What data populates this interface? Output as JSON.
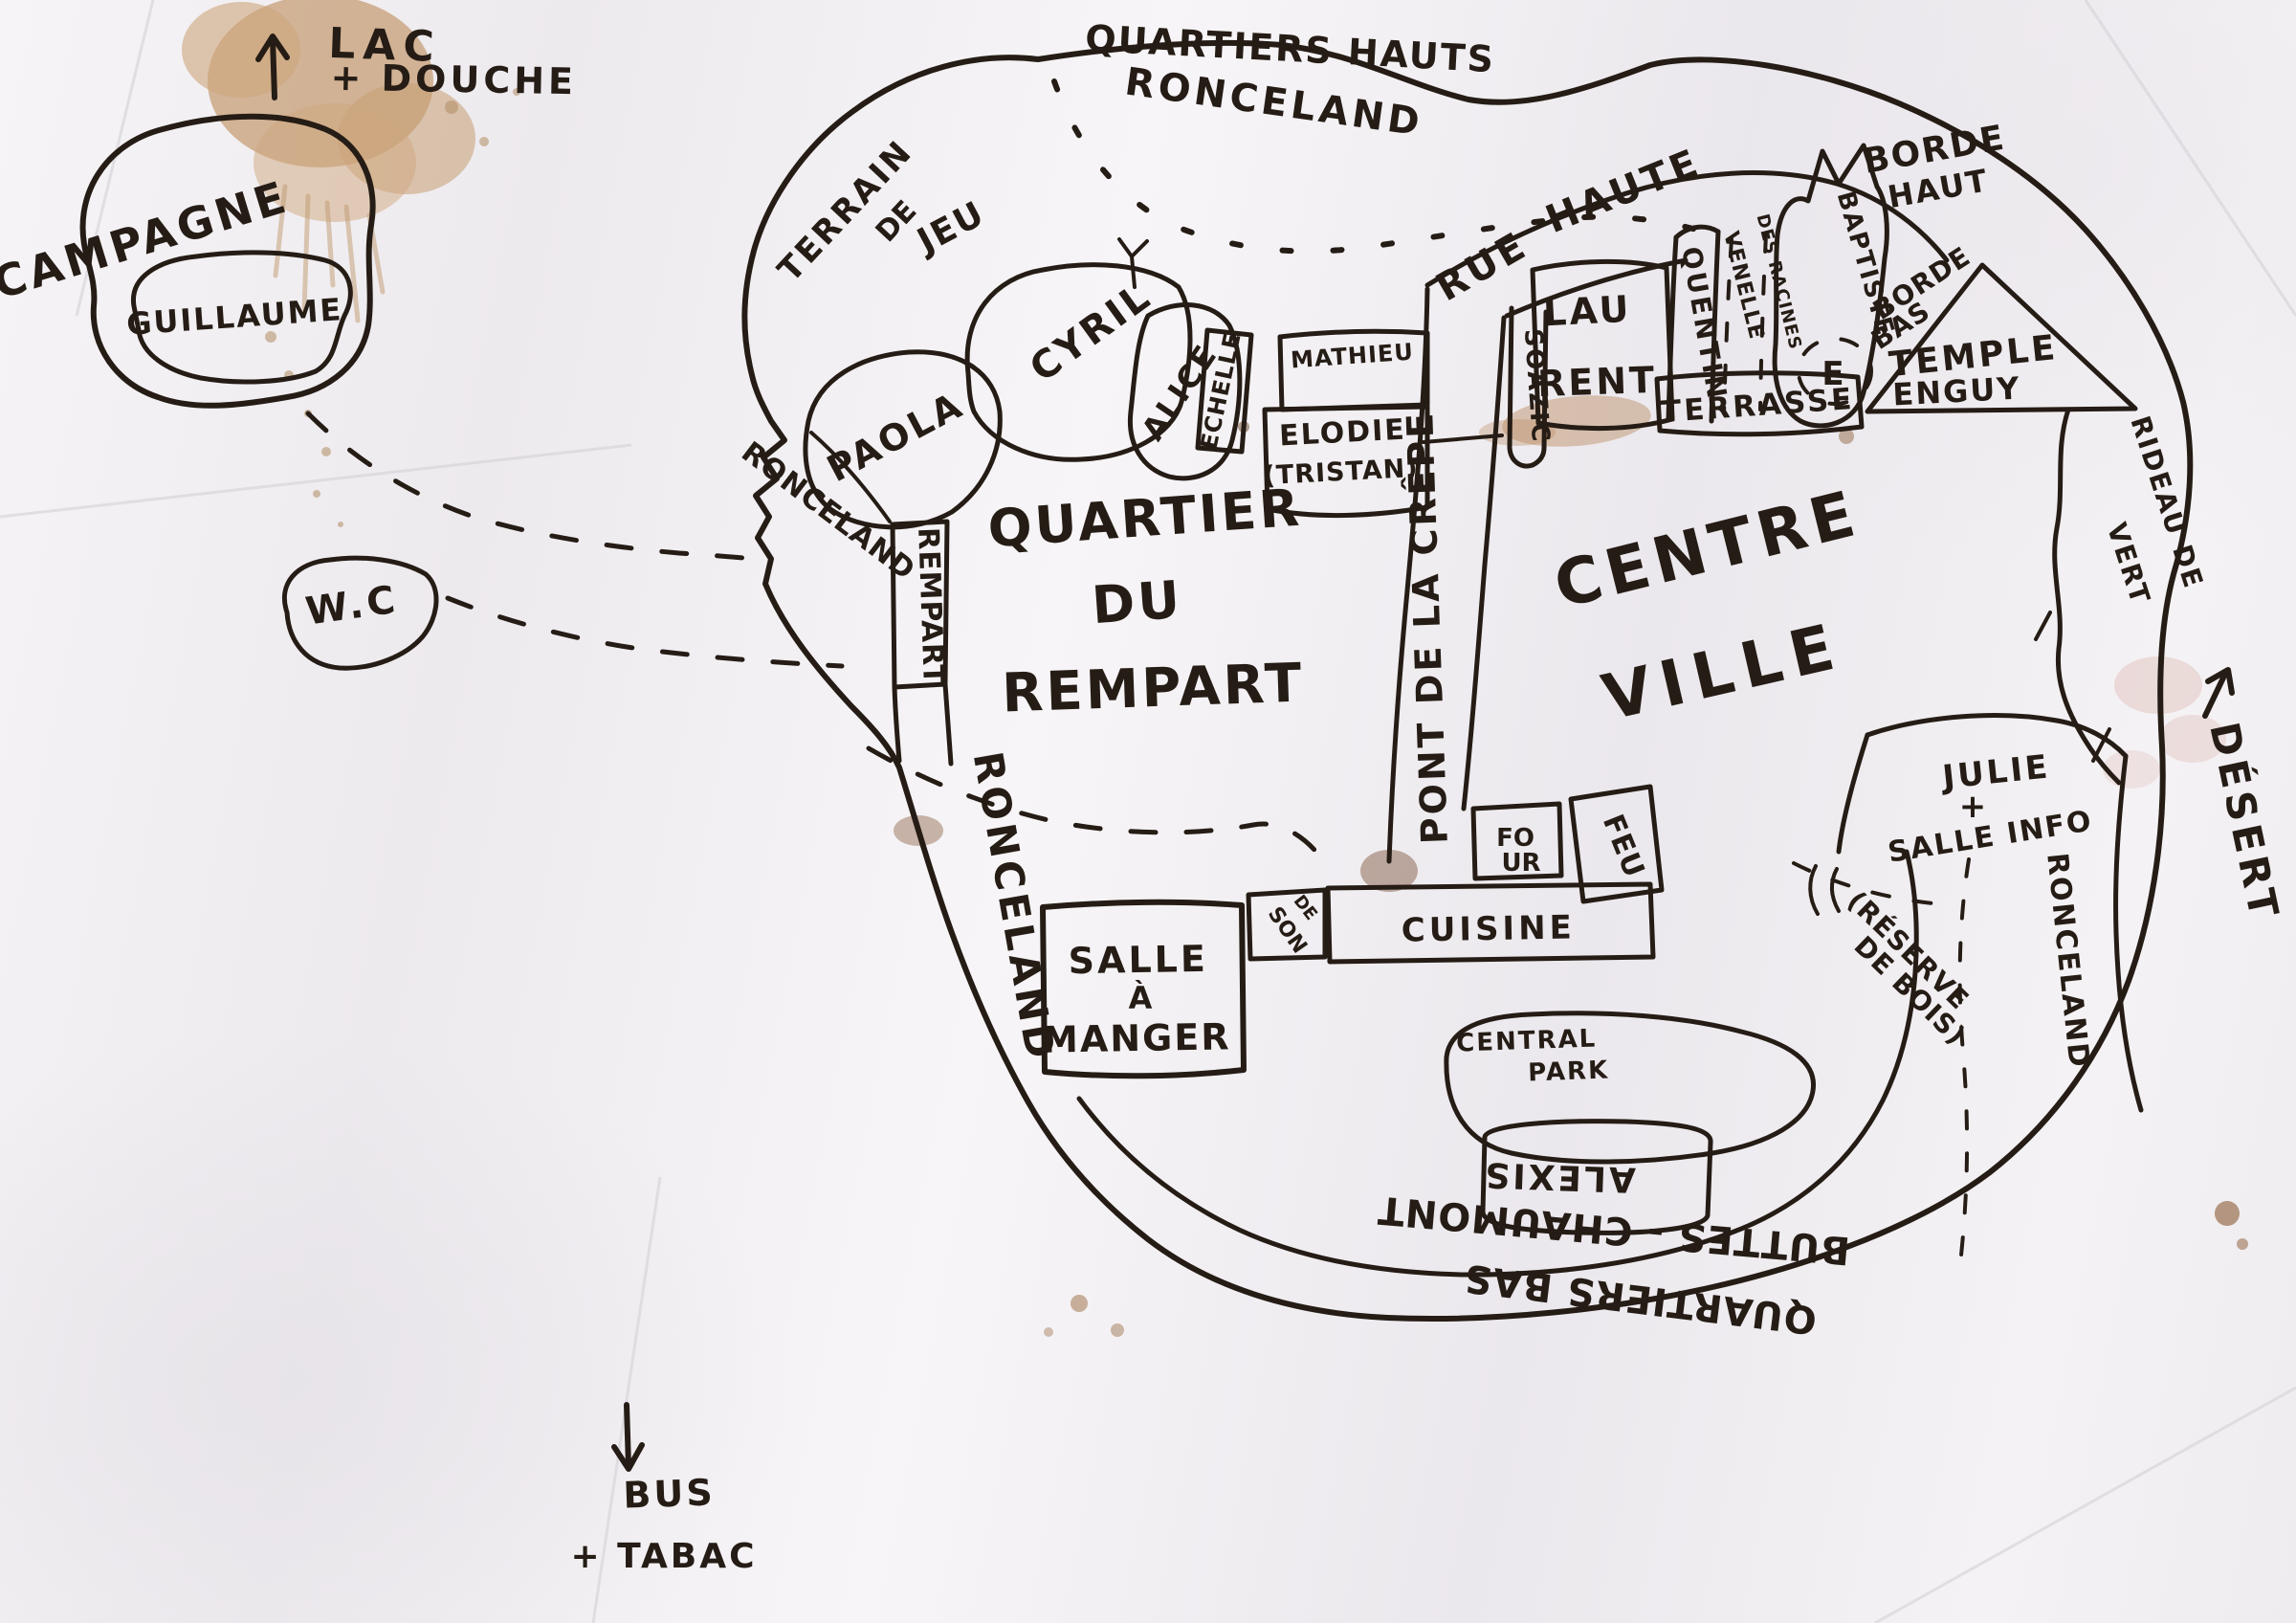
{
  "colors": {
    "ink": "#251c15",
    "paper": "#f2f0f3",
    "stain": "#c59b71"
  },
  "icons": {
    "arrow_up": "↑",
    "arrow_down": "↓"
  },
  "labels": {
    "lac": "LAC",
    "douche": "+ DOUCHE",
    "campagne": "CAMPAGNE",
    "guillaume": "GUILLAUME",
    "wc": "W.C",
    "bus": "BUS",
    "tabac": "+ TABAC",
    "desert": "DÉSERT",
    "quartiers_hauts": "QUARTIERS HAUTS",
    "ronceland_top": "RONCELAND",
    "terrain": "TERRAIN",
    "terrain_de": "DE",
    "jeu": "JEU",
    "paola": "PAOLA",
    "cyril": "CYRIL",
    "alice": "ALICE",
    "echelle": "ECHELLE",
    "mathieu": "MATHIEU",
    "elodie": "ELODIE",
    "tristan": "(TRISTAN)",
    "soazic": "SOAZIC",
    "lau": "LAU",
    "rent": "RENT",
    "quentin": "QUENTIN",
    "venelle": "VENELLE",
    "des_racines": "DES RACINES",
    "baptiste": "BAPTISTE",
    "e_spot": "E",
    "borde_haut_1": "BORDE",
    "borde_haut_2": "HAUT",
    "borde_bas_1": "BORDE",
    "borde_bas_2": "BAS",
    "temple": "TEMPLE",
    "enguy": "ENGUY",
    "terrasse": "TERRASSE",
    "rue": "RUE",
    "haute": "HAUTE",
    "rideau_de": "RIDEAU DE",
    "vert": "VERT",
    "quartier": "QUARTIER",
    "du": "DU",
    "rempart": "REMPART",
    "centre": "CENTRE",
    "ville": "VILLE",
    "pont_de_la_crepe": "PONT DE LA CRÊPE",
    "rempart_road": "REMPART",
    "ronceland_west": "RONCELAND",
    "ronceland_sw": "RONCELAND",
    "ronceland_east": "RONCELAND",
    "fo": "FO",
    "ur": "UR",
    "feu": "FEU",
    "cuisine": "CUISINE",
    "son_de": "DE",
    "son": "SON",
    "salle": "SALLE",
    "a_grave": "À",
    "manger": "MANGER",
    "central": "CENTRAL",
    "park": "PARK",
    "alexis": "ALEXIS",
    "buttes_chaumont": "BUTTES - CHAUMONT",
    "quartiers_bas": "QUARTIERS BAS",
    "julie": "JULIE",
    "julie_plus": "+",
    "salle_info": "SALLE INFO",
    "reserve_1": "(RÉSERVE",
    "reserve_2": "DE BOIS)"
  }
}
